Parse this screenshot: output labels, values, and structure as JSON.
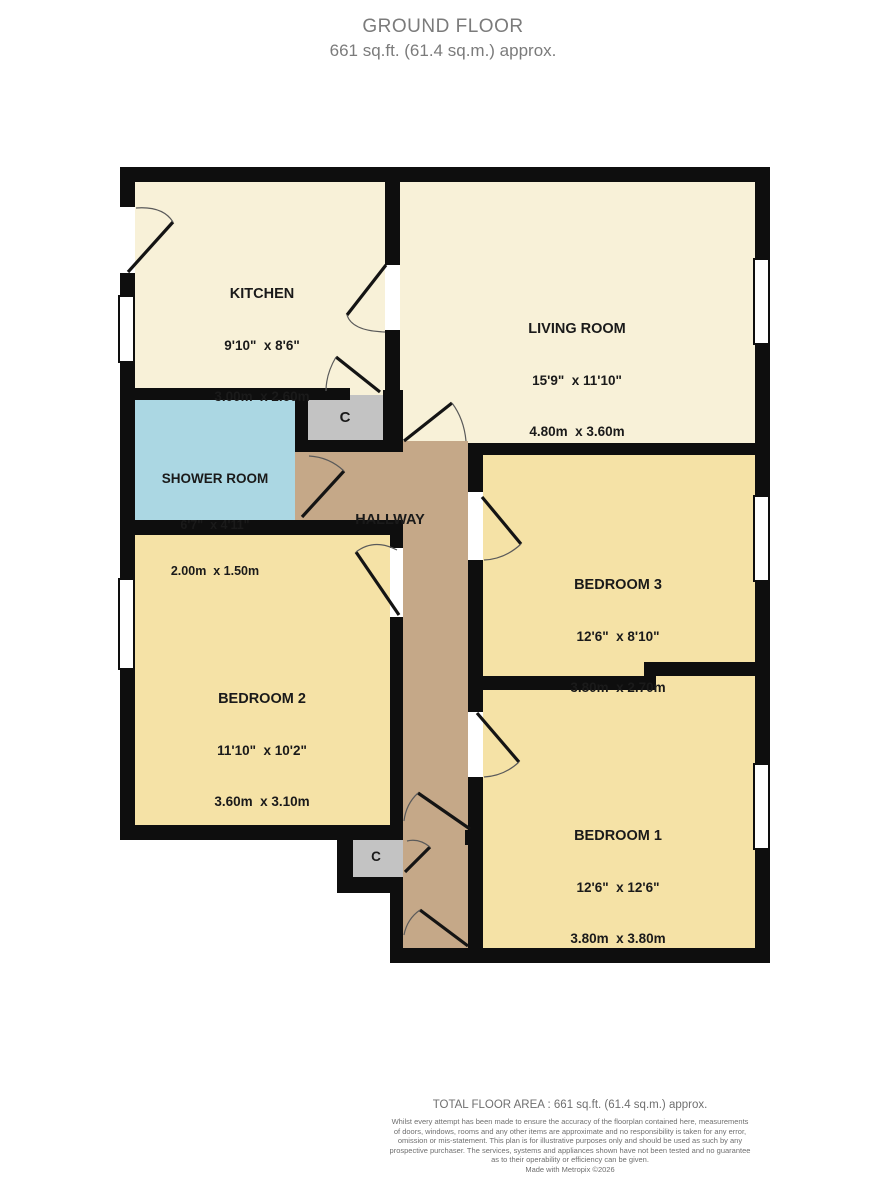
{
  "title": {
    "line1": "GROUND FLOOR",
    "line2": "661 sq.ft. (61.4 sq.m.) approx."
  },
  "rooms": {
    "kitchen": {
      "name": "KITCHEN",
      "imperial": "9'10\"  x 8'6\"",
      "metric": "3.00m  x 2.60m"
    },
    "living_room": {
      "name": "LIVING ROOM",
      "imperial": "15'9\"  x 11'10\"",
      "metric": "4.80m  x 3.60m"
    },
    "shower_room": {
      "name": "SHOWER ROOM",
      "imperial": "6'7\"  x 4'11\"",
      "metric": "2.00m  x 1.50m"
    },
    "hallway": {
      "name": "HALLWAY"
    },
    "bedroom_1": {
      "name": "BEDROOM 1",
      "imperial": "12'6\"  x 12'6\"",
      "metric": "3.80m  x 3.80m"
    },
    "bedroom_2": {
      "name": "BEDROOM 2",
      "imperial": "11'10\"  x 10'2\"",
      "metric": "3.60m  x 3.10m"
    },
    "bedroom_3": {
      "name": "BEDROOM 3",
      "imperial": "12'6\"  x 8'10\"",
      "metric": "3.80m  x 2.70m"
    },
    "cupboard_top": {
      "label": "C"
    },
    "cupboard_bottom": {
      "label": "C"
    }
  },
  "colors": {
    "wall": "#0e0e0e",
    "room_cream": "#F8F1D8",
    "room_yellow": "#F5E2A6",
    "hallway_tan": "#C5A888",
    "shower_blue": "#ABD7E3",
    "cupboard_gray": "#C3C3C3",
    "title_text": "#7b7b7b",
    "footer_text": "#6f6f6f",
    "label_text": "#1a1a1a"
  },
  "footer": {
    "total": "TOTAL FLOOR AREA : 661 sq.ft. (61.4 sq.m.) approx.",
    "disclaimer": [
      "Whilst every attempt has been made to ensure the accuracy of the floorplan contained here, measurements",
      "of doors, windows, rooms and any other items are approximate and no responsibility is taken for any error,",
      "omission or mis-statement. This plan is for illustrative purposes only and should be used as such by any",
      "prospective purchaser. The services, systems and appliances shown have not been tested and no guarantee",
      "as to their operability or efficiency can be given."
    ],
    "credit": "Made with Metropix ©2026"
  }
}
